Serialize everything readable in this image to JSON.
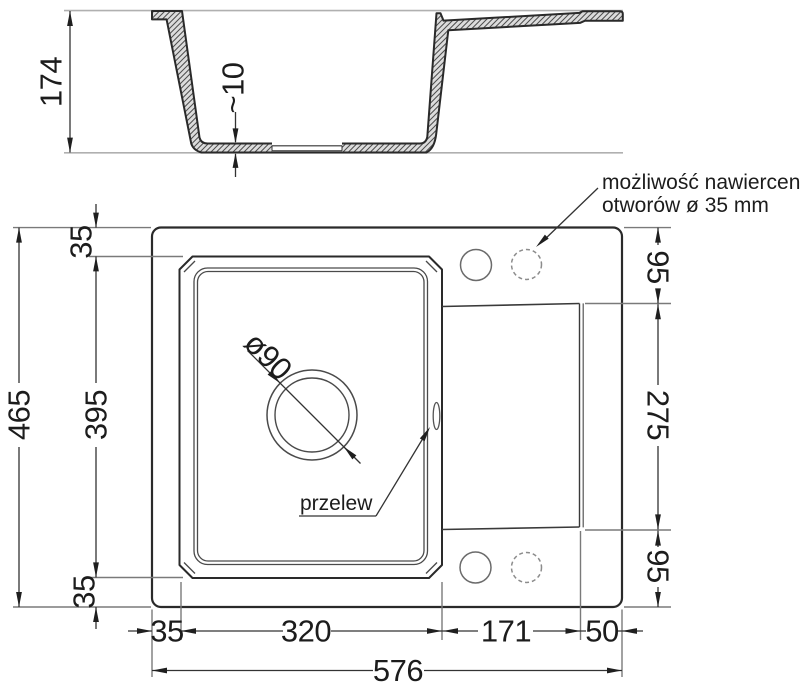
{
  "dims": {
    "depth": "174",
    "bottom_thickness": "~10",
    "total_length": "465",
    "rim_top": "35",
    "bowl_length": "395",
    "rim_bottom": "35",
    "ledge_top": "95",
    "drainer_length": "275",
    "ledge_bottom": "95",
    "rim_left": "35",
    "bowl_width": "320",
    "drainer_width": "171",
    "right_edge": "50",
    "total_width": "576"
  },
  "labels": {
    "drain_diameter": "ø90",
    "overflow": "przelew",
    "drill_note_line1": "możliwość nawiercenia",
    "drill_note_line2": "otworów ø 35 mm"
  }
}
